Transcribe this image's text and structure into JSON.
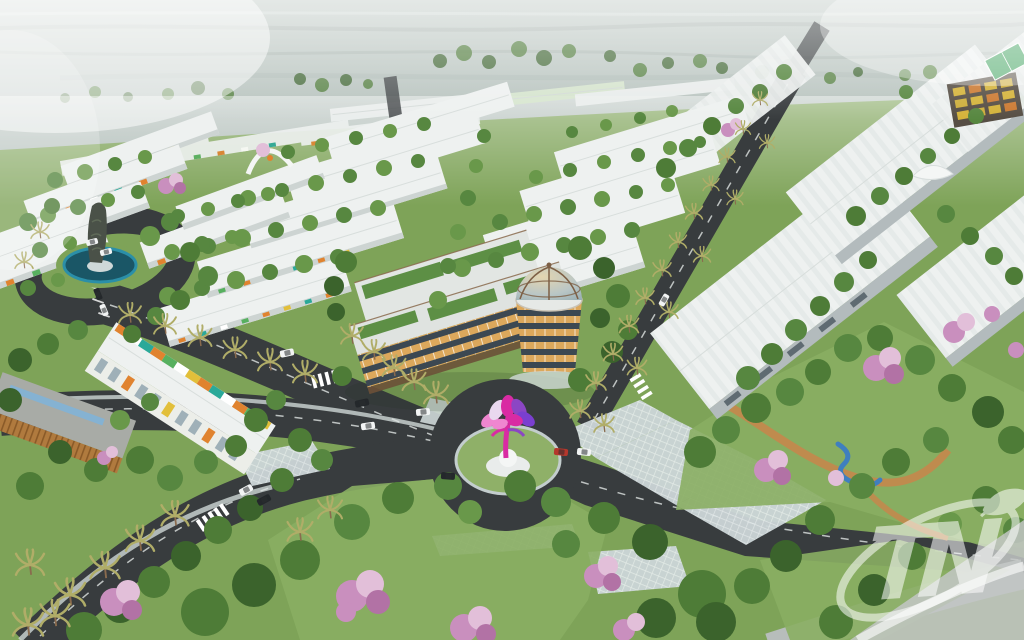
{
  "meta": {
    "alt": "Aerial 3D architectural rendering of a master-planned estate: rows of white-roofed townhouses with colorful facade accents, large white commercial halls, a four-storey landmark building with a glass dome and rooftop garden, a roundabout with a pink lotus-tree sculpture, a monument pool, palm-lined asphalt roads with cars, parks with pink flowering trees, hazy undeveloped land on the horizon, and a translucent TN watermark logo in the lower right corner."
  },
  "watermark": {
    "text": "TN"
  },
  "palette": {
    "road": "#383c3e",
    "road-light": "#b7bdbb",
    "road-line": "#dfe3e2",
    "sidewalk": "#c6cecc",
    "grass": "#7ea358",
    "lawn": "#8aae63",
    "tree-1": "#4e7c37",
    "tree-2": "#3b632c",
    "tree-3": "#69984a",
    "tree-4": "#578740",
    "pink-1": "#c98fbe",
    "pink-2": "#e2bfd9",
    "pink-3": "#b272a5",
    "roof": "#eef1f0",
    "wall": "#b3bbbd",
    "accent-orange": "#e0832f",
    "accent-teal": "#2aa999",
    "accent-green": "#57b05f",
    "accent-yellow": "#e2bf3a",
    "palm": "#b0ad68",
    "trunk": "#8a6b4e",
    "bronze": "#8a6b4e",
    "landmark-dark": "#3c4852",
    "landmark-glass": "#dca85c",
    "dome-glass": "#a8bfc6",
    "sculpture-magenta": "#d92ba3",
    "sculpture-purple": "#8b46c4",
    "sculpture-pink": "#ef86d0",
    "pool-teal": "#2b8fa8",
    "pool-dark": "#1a5666",
    "water-blue": "#3f7fbf",
    "path-orange": "#c9854b",
    "car-white": "#f2f4f4",
    "car-black": "#24282b",
    "car-red": "#b5372c",
    "haze": "#c2ccc8",
    "watermark": "#ffffff",
    "wedge": "#c3c7c6"
  }
}
